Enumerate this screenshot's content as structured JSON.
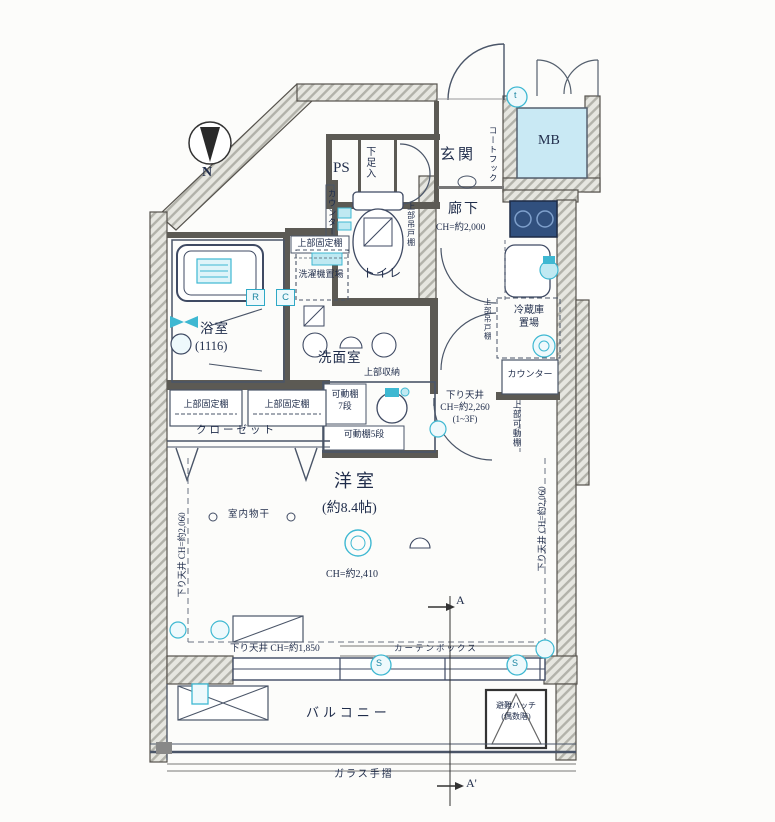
{
  "title": "間取り図",
  "colors": {
    "teal": "#3eb8d2",
    "teal_light": "#bfe9f2",
    "wall_hatch": "#b2b2aa",
    "ink": "#1f2c4a",
    "mb_fill": "#c9e9f4",
    "stove_fill": "#31507e"
  },
  "compass": {
    "label": "N"
  },
  "entrance": {
    "genkan": "玄関",
    "ps": "PS",
    "getabako": "下足入",
    "mb": "MB",
    "coat_hook": "コートフック",
    "symbol_t": "t"
  },
  "corridor": {
    "name": "廊下",
    "ch": "CH=約2,000",
    "drop_a": "下り天井",
    "drop_b": "CH=約2,260",
    "drop_c": "(1~3F)"
  },
  "toilet": {
    "name": "トイレ",
    "shelf": "上部吊戸棚",
    "counter": "カウンター"
  },
  "bath": {
    "name": "浴室",
    "size": "(1116)"
  },
  "washroom": {
    "name": "洗面室",
    "washer_shelf": "上部固定棚",
    "washer": "洗濯機置場",
    "upper_storage": "上部収納",
    "shelf7_a": "可動棚",
    "shelf7_b": "7段",
    "shelf5": "可動棚5段",
    "symbol_r": "R",
    "symbol_c": "C"
  },
  "kitchen": {
    "fridge_a": "冷蔵庫",
    "fridge_b": "置場",
    "fridge_shelf": "上部吊戸棚",
    "counter": "カウンター",
    "counter_shelf": "上部可動棚"
  },
  "main_room": {
    "name": "洋室",
    "size": "(約8.4帖)",
    "ch": "CH=約2,410",
    "drying": "室内物干",
    "closet": "クローゼット",
    "closet_shelf_left": "上部固定棚",
    "closet_shelf_right": "上部固定棚",
    "drop_left": "下り天井 CH=約2,060",
    "drop_right": "下り天井 CH=約2,060",
    "drop_window": "下り天井 CH=約1,850",
    "curtain_box": "カーテンボックス"
  },
  "balcony": {
    "name": "バルコニー",
    "hatch_a": "避難ハッチ",
    "hatch_b": "(偶数階)",
    "rail": "ガラス手摺",
    "symbol_s": "S"
  },
  "section": {
    "a": "A",
    "a_prime": "A'"
  }
}
